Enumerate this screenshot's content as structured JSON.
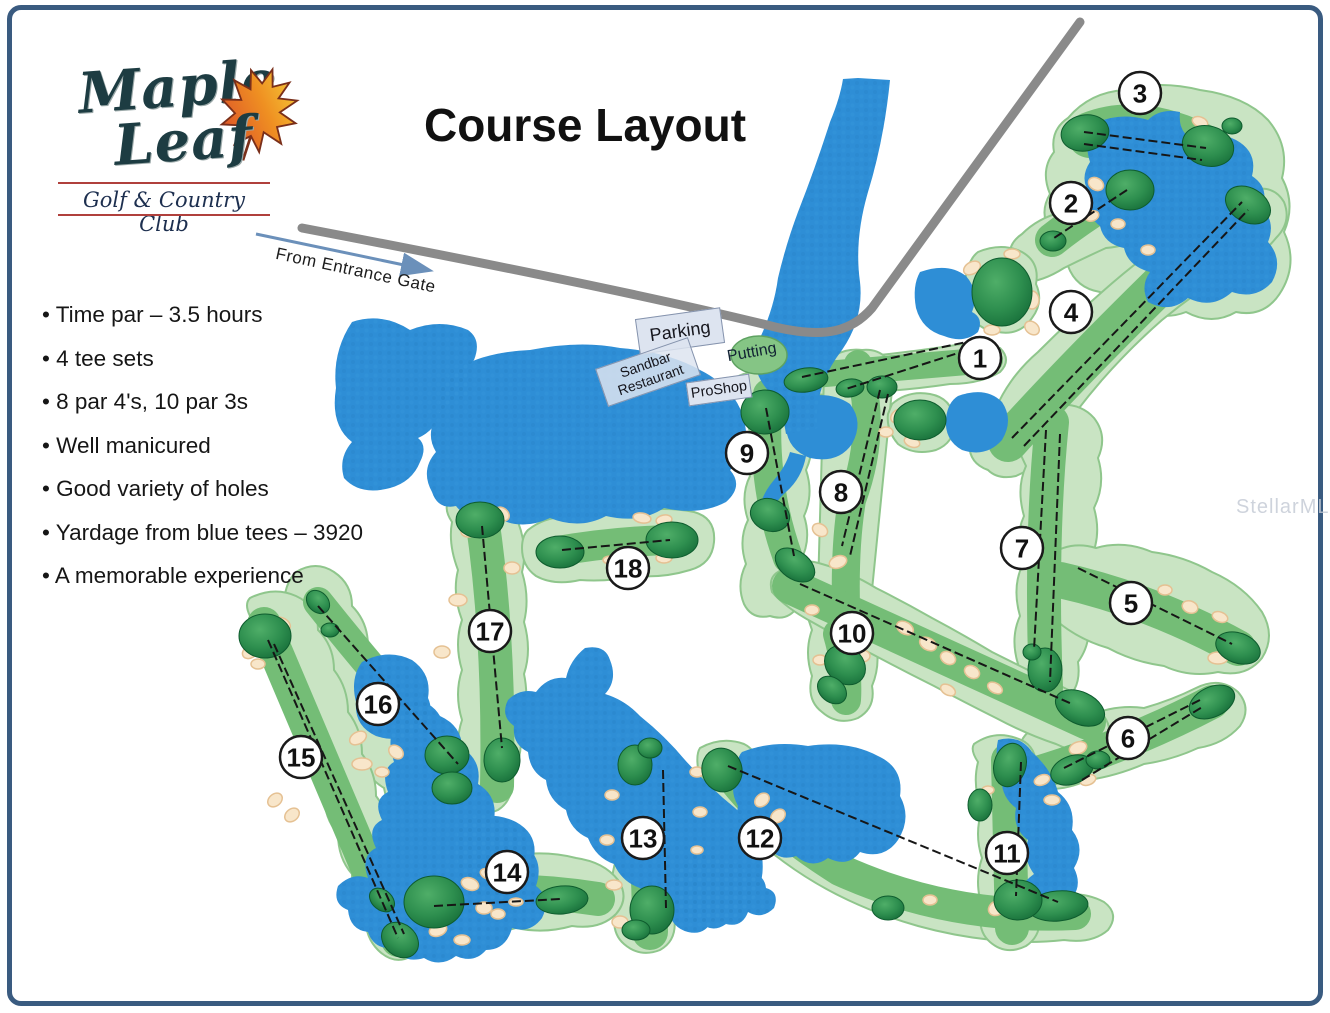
{
  "logo": {
    "line1": "Maple",
    "line2": "Leaf",
    "subtitle": "Golf & Country Club",
    "icon": "maple-leaf-icon"
  },
  "title": "Course Layout",
  "entrance": {
    "label": "From Entrance Gate"
  },
  "facilities": {
    "parking": "Parking",
    "restaurant_line1": "Sandbar",
    "restaurant_line2": "Restaurant",
    "proshop": "ProShop",
    "putting": "Putting"
  },
  "info": {
    "bullets": [
      "Time par – 3.5 hours",
      "4 tee sets",
      "8 par 4's, 10 par 3s",
      "Well manicured",
      "Good variety of holes",
      "Yardage from blue tees – 3920",
      "A memorable experience"
    ]
  },
  "watermark": "StellarMLS",
  "colors": {
    "water": "#2e8ed6",
    "rough": "#c9e4c3",
    "fairway": "#74bd76",
    "green_dark": "#156c38",
    "bunker": "#f8e6ca",
    "road": "#8a8a8a",
    "page_border": "#3a5b80",
    "arrow_blue": "#6b90ba",
    "logo_red": "#b0403c"
  },
  "course": {
    "holes": [
      {
        "number": "1",
        "cx": 980,
        "cy": 358,
        "lines": [
          [
            976,
            340,
            802,
            377
          ],
          [
            980,
            346,
            846,
            389
          ]
        ]
      },
      {
        "number": "2",
        "cx": 1071,
        "cy": 203,
        "lines": [
          [
            1127,
            190,
            1054,
            238
          ]
        ]
      },
      {
        "number": "3",
        "cx": 1140,
        "cy": 93,
        "lines": [
          [
            1084,
            132,
            1206,
            148
          ],
          [
            1084,
            144,
            1202,
            160
          ]
        ]
      },
      {
        "number": "4",
        "cx": 1071,
        "cy": 312,
        "lines": [
          [
            1012,
            438,
            1242,
            202
          ],
          [
            1024,
            446,
            1248,
            210
          ]
        ]
      },
      {
        "number": "5",
        "cx": 1131,
        "cy": 603,
        "lines": [
          [
            1078,
            568,
            1232,
            644
          ]
        ]
      },
      {
        "number": "6",
        "cx": 1128,
        "cy": 738,
        "lines": [
          [
            1064,
            768,
            1200,
            700
          ],
          [
            1082,
            780,
            1204,
            706
          ]
        ]
      },
      {
        "number": "7",
        "cx": 1022,
        "cy": 548,
        "lines": [
          [
            1046,
            430,
            1034,
            650
          ],
          [
            1060,
            434,
            1050,
            682
          ]
        ]
      },
      {
        "number": "8",
        "cx": 841,
        "cy": 492,
        "lines": [
          [
            880,
            390,
            842,
            546
          ],
          [
            888,
            394,
            850,
            556
          ]
        ]
      },
      {
        "number": "9",
        "cx": 747,
        "cy": 453,
        "lines": [
          [
            766,
            408,
            794,
            556
          ]
        ]
      },
      {
        "number": "10",
        "cx": 852,
        "cy": 633,
        "lines": [
          [
            800,
            584,
            1072,
            704
          ]
        ]
      },
      {
        "number": "11",
        "cx": 1007,
        "cy": 853,
        "lines": [
          [
            1021,
            762,
            1016,
            896
          ]
        ]
      },
      {
        "number": "12",
        "cx": 760,
        "cy": 838,
        "lines": [
          [
            728,
            766,
            1058,
            902
          ]
        ]
      },
      {
        "number": "13",
        "cx": 643,
        "cy": 838,
        "lines": [
          [
            663,
            770,
            666,
            908
          ]
        ]
      },
      {
        "number": "14",
        "cx": 507,
        "cy": 872,
        "lines": [
          [
            434,
            906,
            560,
            899
          ]
        ]
      },
      {
        "number": "15",
        "cx": 301,
        "cy": 757,
        "lines": [
          [
            268,
            640,
            398,
            938
          ],
          [
            274,
            644,
            404,
            934
          ]
        ]
      },
      {
        "number": "16",
        "cx": 378,
        "cy": 704,
        "lines": [
          [
            318,
            606,
            458,
            764
          ]
        ]
      },
      {
        "number": "17",
        "cx": 490,
        "cy": 631,
        "lines": [
          [
            482,
            526,
            502,
            748
          ]
        ]
      },
      {
        "number": "18",
        "cx": 628,
        "cy": 568,
        "lines": [
          [
            562,
            550,
            670,
            540
          ]
        ]
      }
    ]
  }
}
